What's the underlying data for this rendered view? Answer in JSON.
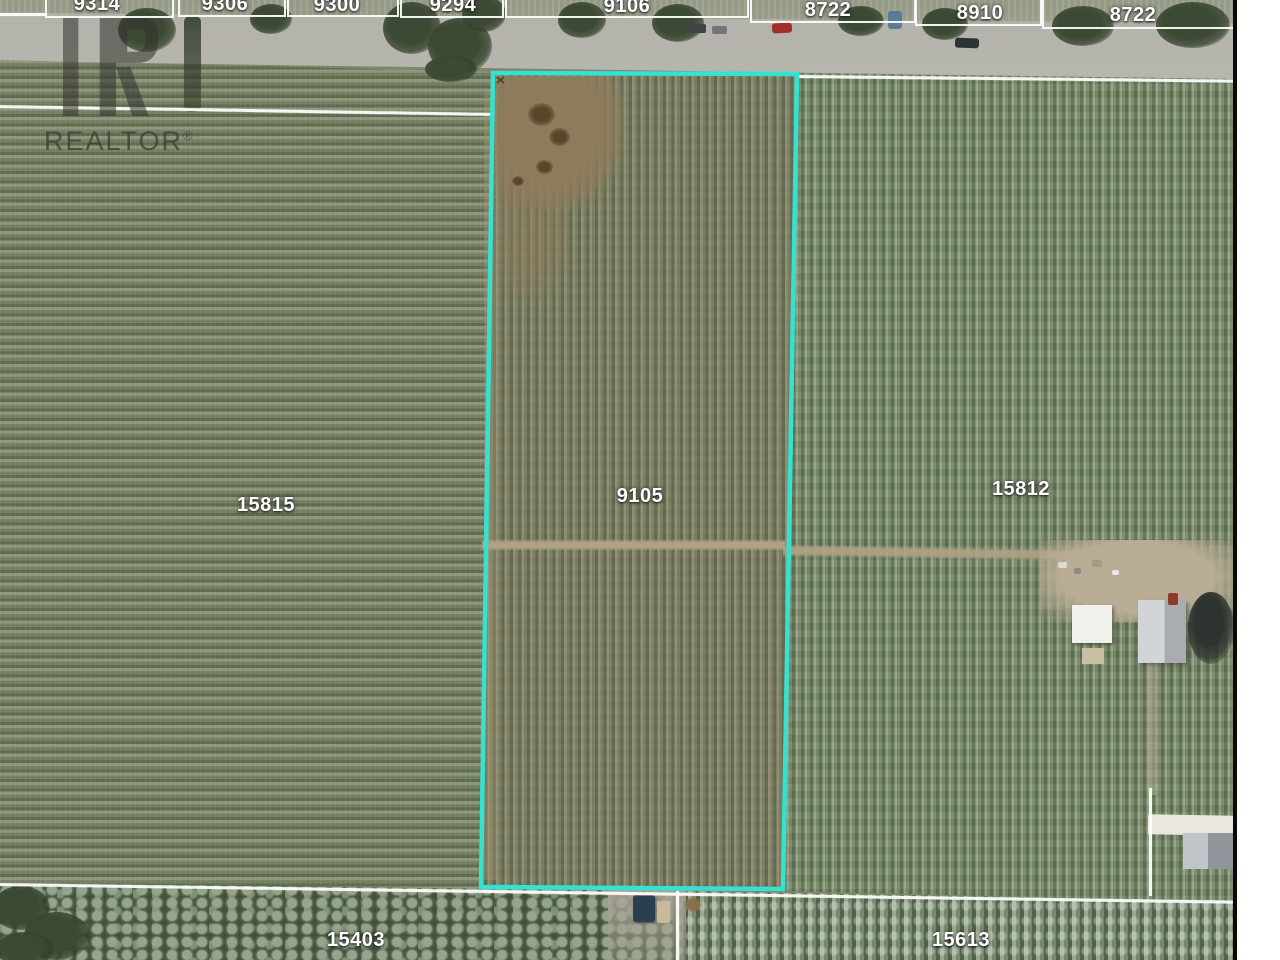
{
  "map_type": "aerial-parcel-map",
  "watermark": {
    "brand": "REALTOR",
    "registered": "®"
  },
  "highlight": {
    "parcel": "9105",
    "color": "#35E2D2"
  },
  "colors": {
    "boundary_line": "#FCFCFA",
    "label_text": "#FFFFFF"
  },
  "parcels": {
    "top_row": [
      "9314",
      "9306",
      "9300",
      "9294",
      "9106",
      "8722",
      "8910",
      "8722"
    ],
    "fields": {
      "left": "15815",
      "center_highlighted": "9105",
      "right": "15812",
      "bottom_left": "15403",
      "bottom_right": "15613"
    }
  }
}
